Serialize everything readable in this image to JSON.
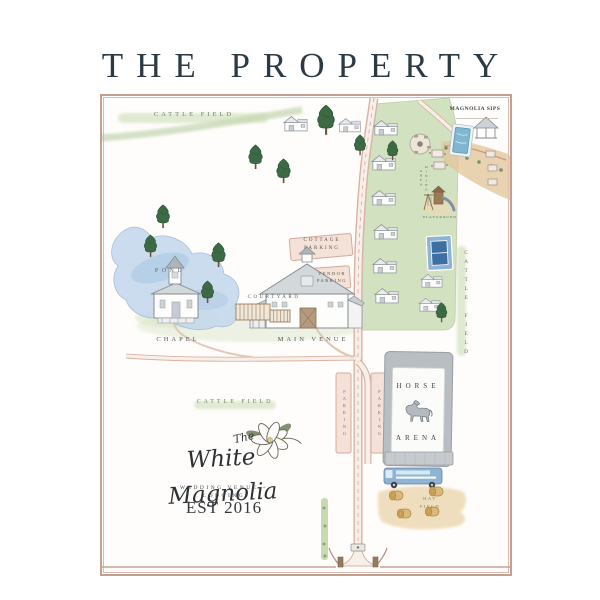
{
  "title": "THE PROPERTY",
  "map": {
    "labels": {
      "cattle_field_top": "CATTLE FIELD",
      "cattle_field_right": "CATTLE FIELD",
      "cattle_field_bottom": "CATTLE FIELD",
      "magnolia_sips": "MAGNOLIA SIPS",
      "dining_area": "DINING AREA",
      "playground": "PLAYGROUND",
      "cottage_parking": "COTTAGE PARKING",
      "vendor_parking": "VENDOR PARKING",
      "pond": "POND",
      "courtyard": "COURTYARD",
      "chapel": "CHAPEL",
      "main_venue": "MAIN VENUE",
      "parking_left": "PARKING",
      "parking_right": "PARKING",
      "horse_arena_line1": "HORSE",
      "horse_arena_line2": "ARENA",
      "hay_field": "HAY FIELD"
    },
    "logo": {
      "prefix": "The",
      "name": "White Magnolia",
      "tagline": "WEDDING VENUE + LODGING",
      "established": "EST 2016"
    },
    "colors": {
      "frame_border": "#c79f92",
      "title_ink": "#2c3a46",
      "foliage_green": "#3b6a44",
      "field_wash": "#c7dab1",
      "pond_blue": "#c6daed",
      "road_rose": "#d8b2a2",
      "parking_pink": "#f4e1d8",
      "arena_gray": "#b9bec2",
      "court_blue": "#3e6fa3",
      "pool_blue": "#7fb6d2",
      "bus_blue": "#8fb3d3",
      "hay_gold": "#d9b97c",
      "sand_tan": "#e3c79e"
    }
  }
}
